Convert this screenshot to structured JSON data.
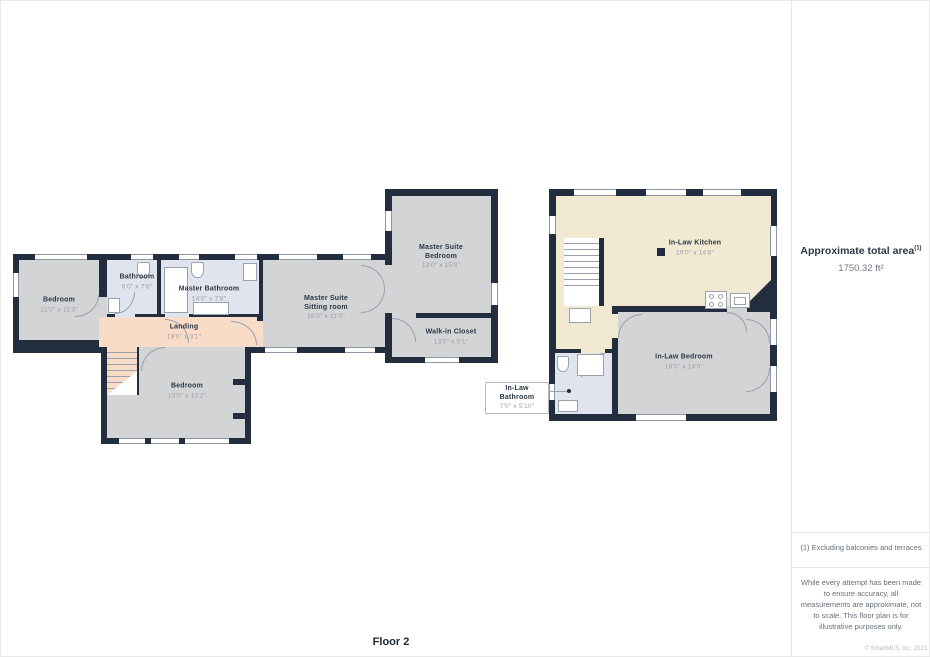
{
  "floor_label": "Floor 2",
  "sidebar": {
    "title": "Approximate total area",
    "title_sup": "(1)",
    "area_value": "1750.32 ft²",
    "footnote": "(1) Excluding balconies and terraces",
    "disclaimer": "While every attempt has been made to ensure accuracy, all measurements are approximate, not to scale. This floor plan is for illustrative purposes only.",
    "copyright": "© SmartMLS, Inc. 2023"
  },
  "rooms": {
    "bedroom1": {
      "name": "Bedroom",
      "dims": "12'0\" x 11'3\""
    },
    "bathroom": {
      "name": "Bathroom",
      "dims": "6'0\" x 7'8\""
    },
    "master_bathroom": {
      "name": "Master Bathroom",
      "dims": "14'0\" x 7'8\""
    },
    "landing": {
      "name": "Landing",
      "dims": "19'0\" x 3'1\""
    },
    "bedroom2": {
      "name": "Bedroom",
      "dims": "13'0\" x 12'2\""
    },
    "sitting_room": {
      "name_line1": "Master Suite",
      "name_line2": "Sitting room",
      "dims": "16'0\" x 11'0\""
    },
    "master_bedroom": {
      "name_line1": "Master Suite",
      "name_line2": "Bedroom",
      "dims": "13'0\" x 15'8\""
    },
    "walk_in_closet": {
      "name": "Walk-in Closet",
      "dims": "13'0\" x 5'1\""
    },
    "inlaw_kitchen": {
      "name": "In-Law Kitchen",
      "dims": "29'0\" x 14'8\""
    },
    "inlaw_bedroom": {
      "name": "In-Law Bedroom",
      "dims": "19'0\" x 14'0\""
    },
    "inlaw_bathroom": {
      "name": "In-Law Bathroom",
      "dims": "7'0\" x 5'10\""
    }
  },
  "colors": {
    "wall": "#222e3d",
    "floor_gray": "#d2d4d6",
    "floor_bathroom": "#dfe4ee",
    "floor_landing": "#f8dcc7",
    "floor_kitchen": "#f2e9d2"
  }
}
